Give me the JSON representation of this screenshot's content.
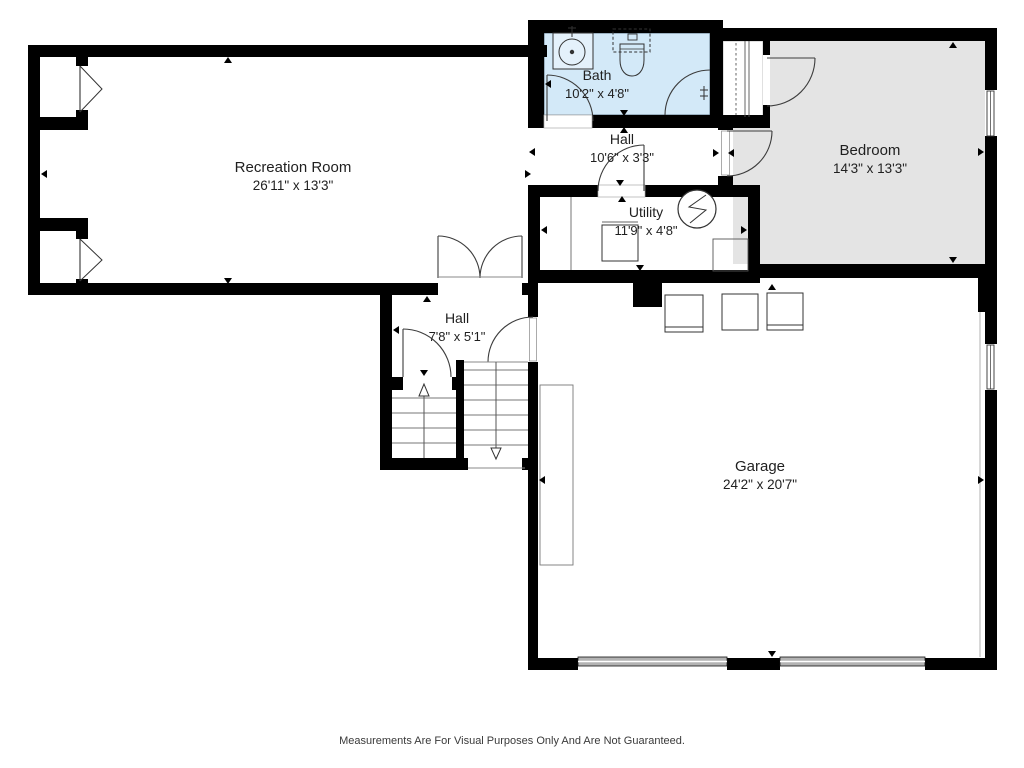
{
  "floorplan": {
    "rooms": [
      {
        "id": "recreation-room",
        "name": "Recreation Room",
        "dimensions": "26'11\" x 13'3\""
      },
      {
        "id": "bath",
        "name": "Bath",
        "dimensions": "10'2\" x 4'8\""
      },
      {
        "id": "hall-upper",
        "name": "Hall",
        "dimensions": "10'6\" x 3'3\""
      },
      {
        "id": "bedroom",
        "name": "Bedroom",
        "dimensions": "14'3\" x 13'3\""
      },
      {
        "id": "utility",
        "name": "Utility",
        "dimensions": "11'9\" x 4'8\""
      },
      {
        "id": "hall-lower",
        "name": "Hall",
        "dimensions": "7'8\" x 5'1\""
      },
      {
        "id": "garage",
        "name": "Garage",
        "dimensions": "24'2\" x 20'7\""
      }
    ],
    "fixtures": {
      "bath": [
        "sink",
        "toilet",
        "corner-shower",
        "entry-door"
      ],
      "utility": [
        "washer",
        "water-heater",
        "corner-unit"
      ],
      "bedroom": [
        "closet",
        "window",
        "entry-door",
        "closet-door"
      ],
      "hall_lower": [
        "double-doors",
        "stairs-up",
        "stairs-down",
        "door-to-stairs",
        "door-to-garage"
      ],
      "garage": [
        "garage-door",
        "garage-door",
        "storage-unit",
        "storage-unit",
        "storage-unit",
        "workbench",
        "window"
      ],
      "recreation_room": [
        "window-well",
        "window-well"
      ]
    },
    "footer": "Measurements Are For Visual Purposes Only And Are Not Guaranteed.",
    "colors": {
      "wall": "#000000",
      "line": "#3c3c3c",
      "bath_fill": "#d3e9f8",
      "bedroom_fill": "#e4e4e4",
      "text": "#1f1f1f",
      "garage_door_fill": "#b3b3b3"
    }
  }
}
